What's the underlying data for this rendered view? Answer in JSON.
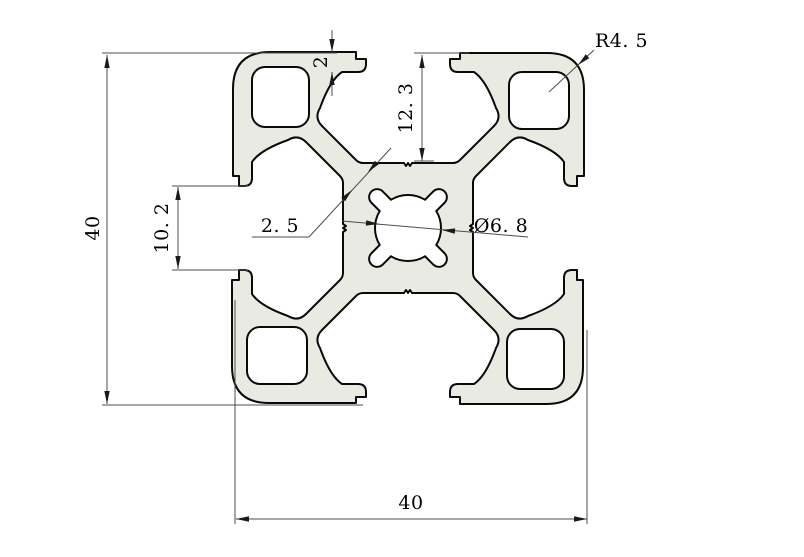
{
  "drawing": {
    "title": "4040 aluminium extrusion profile cross-section",
    "dimensions": {
      "overall_height": "40",
      "overall_width": "40",
      "slot_depth": "12. 3",
      "slot_opening": "10. 2",
      "lip_thickness": "2",
      "web_thickness": "2. 5",
      "center_bore": "Ø6. 8",
      "corner_radius": "R4. 5"
    },
    "colors": {
      "profile_fill": "#e9ebe3",
      "outline": "#0a0a0a",
      "dimension_line": "#4d4d4d",
      "background": "#ffffff"
    }
  }
}
